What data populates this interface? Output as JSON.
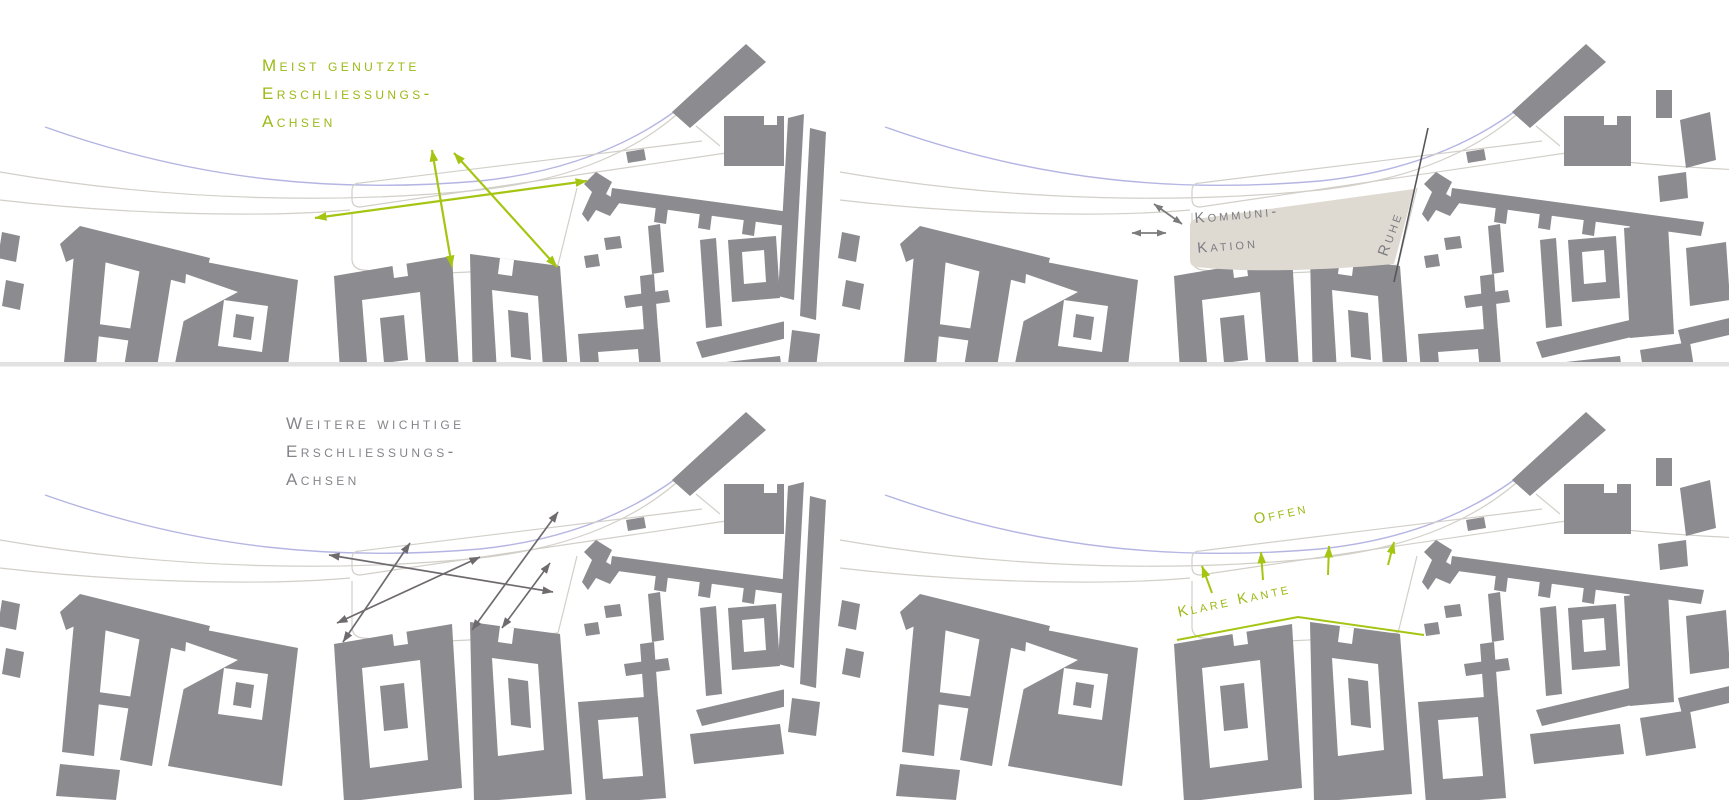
{
  "colors": {
    "annotation_green": "#9cba16",
    "arrow_green": "#a5c513",
    "building_gray": "#8b8b90",
    "annotation_gray": "#85848a",
    "area_beige": "#dedad2",
    "rail_blue": "#b5b5e3",
    "street_outline": "#d2cfc8",
    "ruhe_line_dark": "#55555a"
  },
  "panels": {
    "top_left": {
      "title_lines": [
        "Meist genutzte",
        "Erschliessungs-",
        "Achsen"
      ]
    },
    "top_right": {
      "area_label_lines": [
        "Kommuni-",
        "Kation"
      ],
      "side_label": "Ruhe"
    },
    "bottom_left": {
      "title_lines": [
        "Weitere wichtige",
        "Erschliessungs-",
        "Achsen"
      ]
    },
    "bottom_right": {
      "open_label": "Offen",
      "edge_label": "Klare Kante"
    }
  }
}
